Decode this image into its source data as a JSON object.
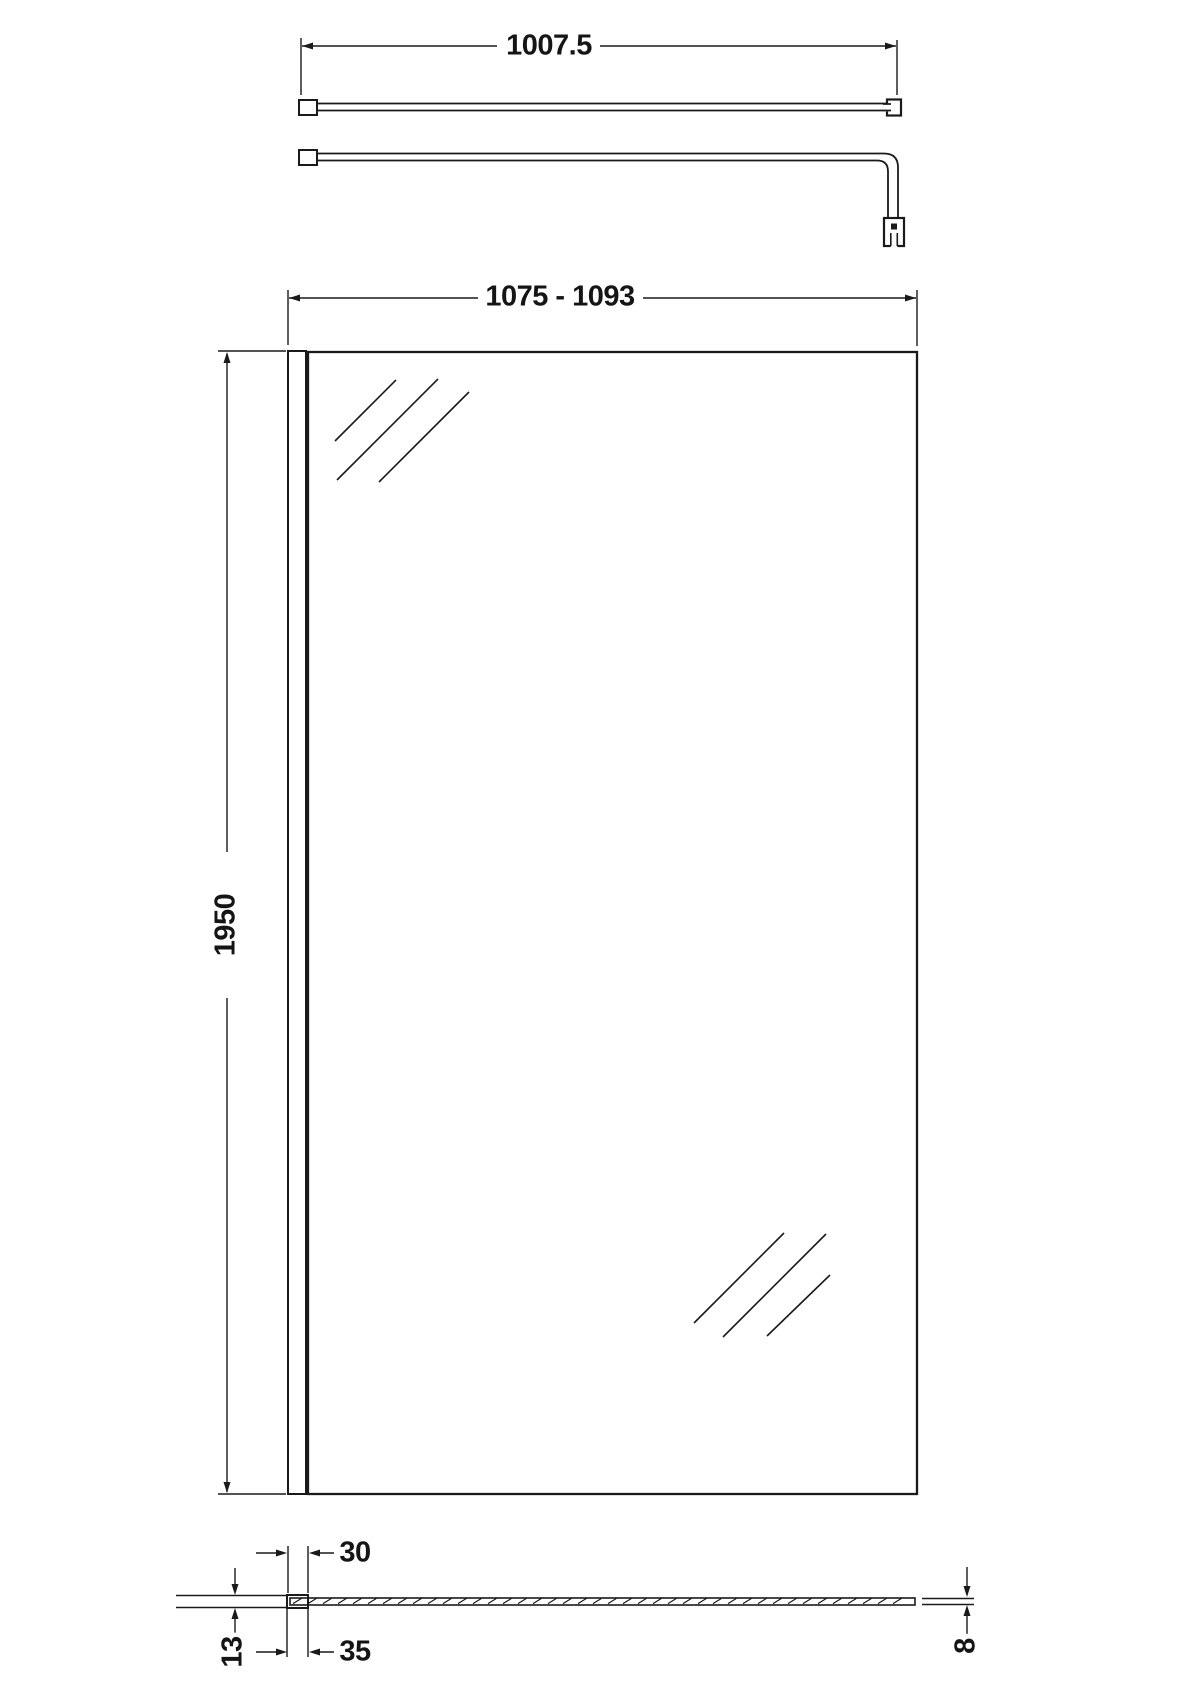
{
  "diagram": {
    "background_color": "#ffffff",
    "line_color": "#1a1a1a",
    "dimensions": {
      "bar_length": "1007.5",
      "overall_width": "1075 - 1093",
      "height": "1950",
      "profile_front_width": "30",
      "profile_overall_depth": "35",
      "profile_thickness": "13",
      "glass_thickness": "8"
    }
  }
}
